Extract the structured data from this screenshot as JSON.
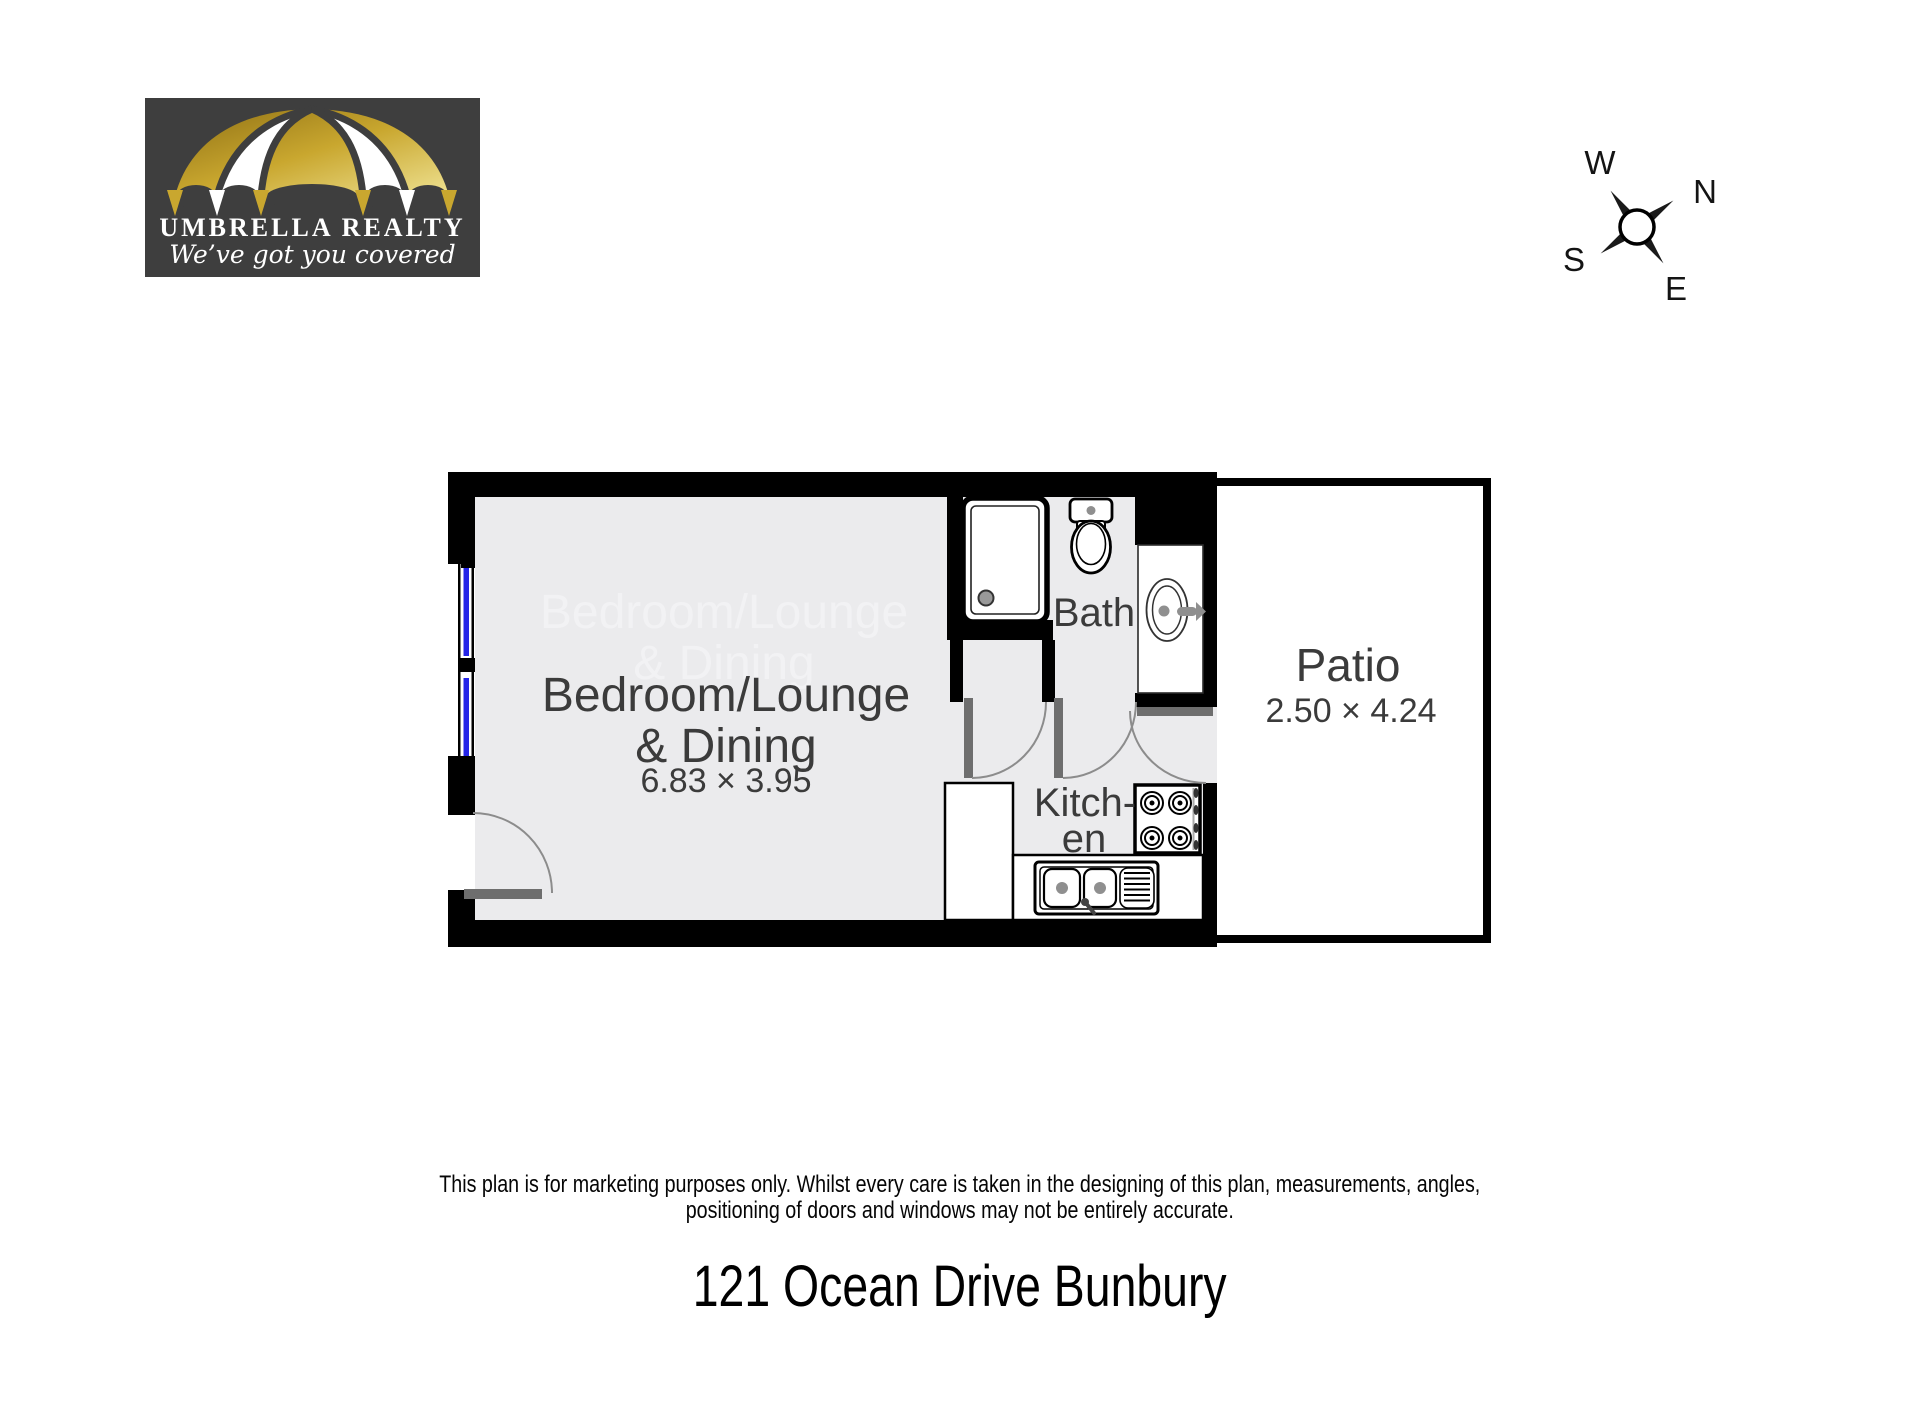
{
  "logo": {
    "company": "UMBRELLA REALTY",
    "tagline": "We’ve got you covered",
    "colors": {
      "background": "#3E3E3E",
      "gold": "#C9A72F",
      "gold_dark": "#8F7014",
      "gold_light": "#EFE292",
      "panel": "#FFFFFF",
      "text": "#FFFFFF"
    }
  },
  "compass": {
    "west": "W",
    "north": "N",
    "south": "S",
    "east": "E"
  },
  "floorplan": {
    "colors": {
      "wall": "#000000",
      "floor": "#EBEBED",
      "patio_floor": "#FFFFFF",
      "door_leaf": "#6E6E6E",
      "arc": "#8C8C8C",
      "window_glass": "#2424E8",
      "label": "#3B3B3B",
      "ghost_label": "#F2F2F4",
      "fixture_accent": "#8F8F8F"
    },
    "rooms": {
      "bedroom": {
        "line1": "Bedroom/Lounge",
        "line2": "& Dining",
        "dims": "6.83 × 3.95"
      },
      "bath": {
        "label": "Bath"
      },
      "kitchen": {
        "line1": "Kitch-",
        "line2": "en"
      },
      "patio": {
        "label": "Patio",
        "dims": "2.50 × 4.24"
      }
    },
    "fixtures": [
      "shower",
      "toilet",
      "vanity-sink",
      "cooktop",
      "kitchen-sink",
      "window",
      "door"
    ]
  },
  "footer": {
    "disclaimer_line1": "This plan is for marketing purposes only. Whilst every care is taken in the designing of this plan, measurements, angles,",
    "disclaimer_line2": "positioning of doors and windows may not be entirely accurate.",
    "address": "121 Ocean Drive Bunbury"
  }
}
